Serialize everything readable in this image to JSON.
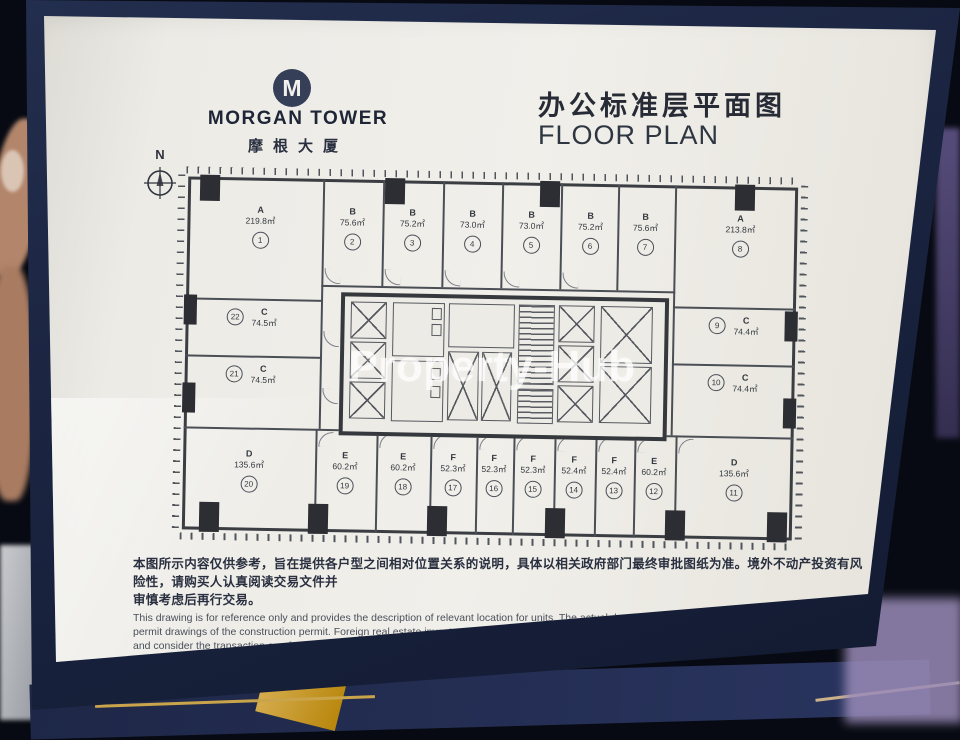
{
  "scene": {
    "board_color": "#1b2440",
    "page_color": "#edebe5",
    "accent_gold": "#c9a44a"
  },
  "header": {
    "logo_letter": "M",
    "brand_en": "MORGAN TOWER",
    "brand_cn": "摩根大厦",
    "title_cn": "办公标准层平面图",
    "title_en": "FLOOR PLAN"
  },
  "compass": {
    "label": "N"
  },
  "watermark": {
    "text": "Property-Hub"
  },
  "floor_plan": {
    "top_units": [
      {
        "letter": "A",
        "area": "219.8㎡",
        "num": "1"
      },
      {
        "letter": "B",
        "area": "75.6㎡",
        "num": "2"
      },
      {
        "letter": "B",
        "area": "75.2㎡",
        "num": "3"
      },
      {
        "letter": "B",
        "area": "73.0㎡",
        "num": "4"
      },
      {
        "letter": "B",
        "area": "73.0㎡",
        "num": "5"
      },
      {
        "letter": "B",
        "area": "75.2㎡",
        "num": "6"
      },
      {
        "letter": "B",
        "area": "75.6㎡",
        "num": "7"
      },
      {
        "letter": "A",
        "area": "213.8㎡",
        "num": "8"
      }
    ],
    "right_units": [
      {
        "letter": "C",
        "area": "74.4㎡",
        "num": "9"
      },
      {
        "letter": "C",
        "area": "74.4㎡",
        "num": "10"
      }
    ],
    "bottom_units": [
      {
        "letter": "D",
        "area": "135.6㎡",
        "num": "20"
      },
      {
        "letter": "E",
        "area": "60.2㎡",
        "num": "19"
      },
      {
        "letter": "E",
        "area": "60.2㎡",
        "num": "18"
      },
      {
        "letter": "F",
        "area": "52.3㎡",
        "num": "17"
      },
      {
        "letter": "F",
        "area": "52.3㎡",
        "num": "16"
      },
      {
        "letter": "F",
        "area": "52.3㎡",
        "num": "15"
      },
      {
        "letter": "F",
        "area": "52.4㎡",
        "num": "14"
      },
      {
        "letter": "F",
        "area": "52.4㎡",
        "num": "13"
      },
      {
        "letter": "E",
        "area": "60.2㎡",
        "num": "12"
      },
      {
        "letter": "D",
        "area": "135.6㎡",
        "num": "11"
      }
    ],
    "left_units": [
      {
        "letter": "C",
        "area": "74.5㎡",
        "num": "22"
      },
      {
        "letter": "C",
        "area": "74.5㎡",
        "num": "21"
      }
    ]
  },
  "disclaimer": {
    "cn_line1": "本图所示内容仅供参考，旨在提供各户型之间相对位置关系的说明，具体以相关政府部门最终审批图纸为准。境外不动产投资有风险性，请购买人认真阅读交易文件并",
    "cn_line2": "审慎考虑后再行交易。",
    "en_line1": "This drawing is for reference only and provides the description of relevant location for units. The actual drawings are based on the approved",
    "en_line2": "permit drawings of the construction permit. Foreign real estate investment is risky. Investors are requested to review the sales documents",
    "en_line3": "and consider the transaction carefully."
  }
}
